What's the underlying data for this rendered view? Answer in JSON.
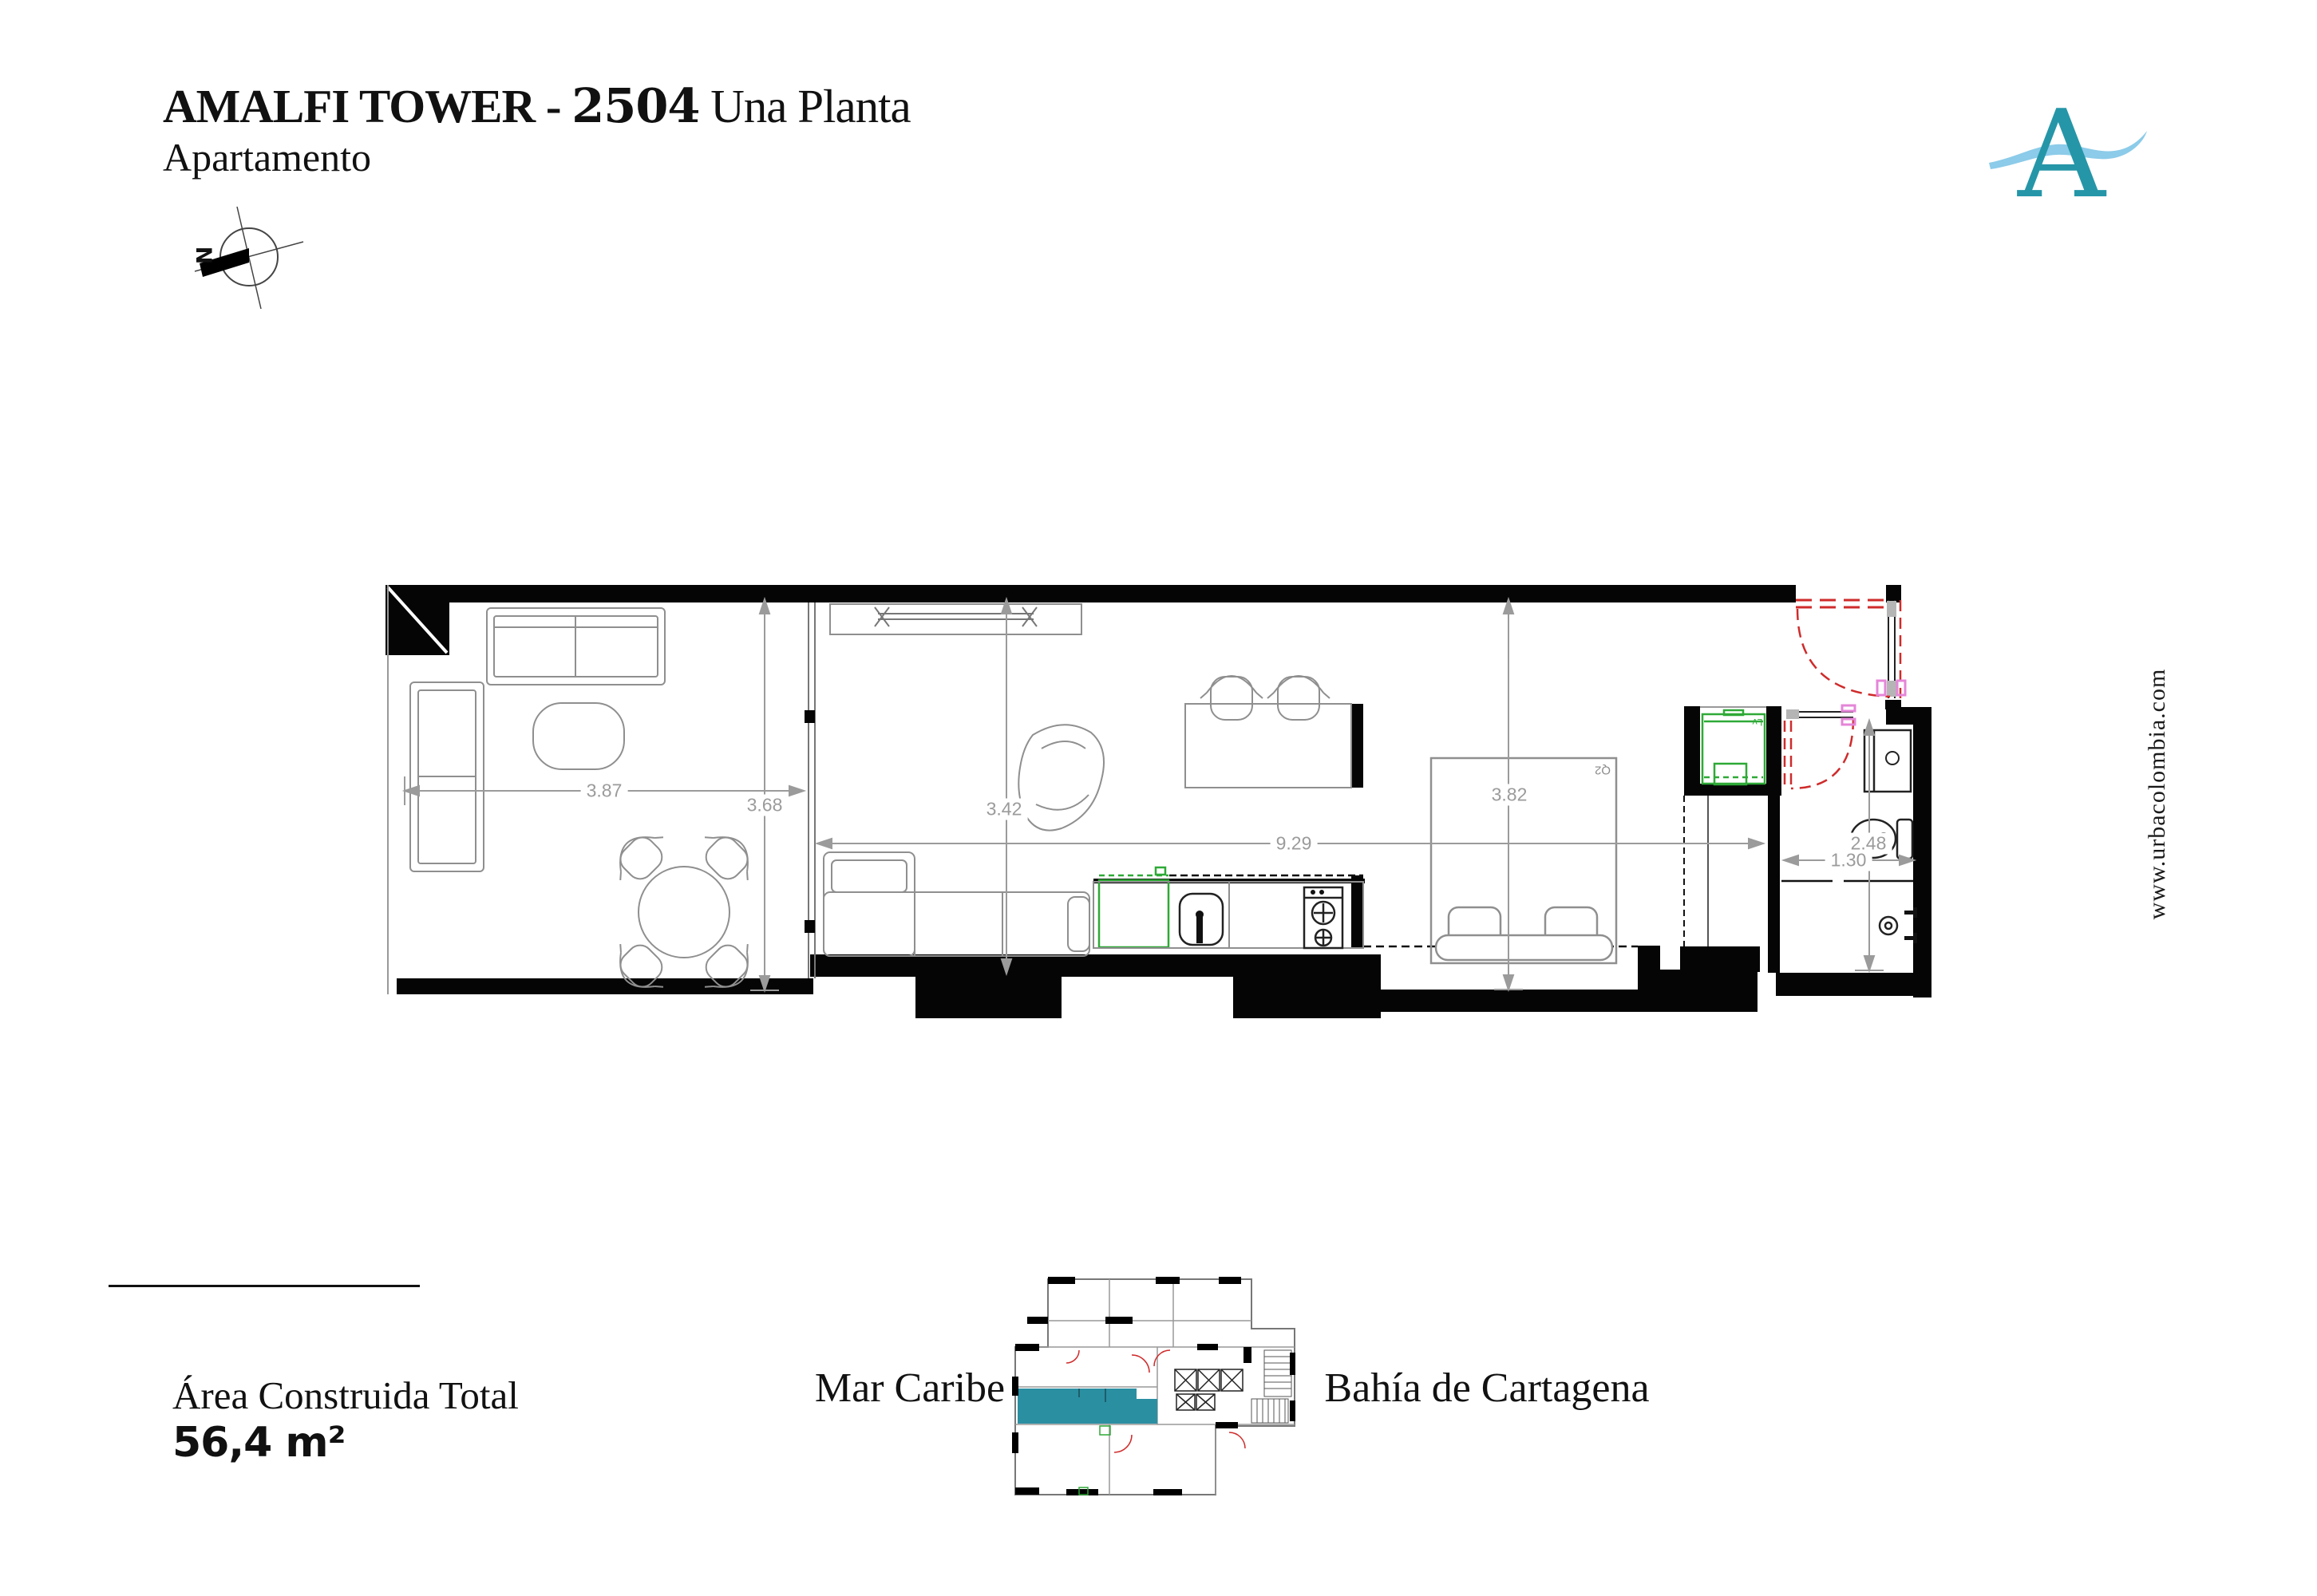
{
  "header": {
    "title_main": "AMALFI TOWER - ",
    "title_number": "2504",
    "title_suffix": " Una Planta",
    "subtitle": "Apartamento"
  },
  "compass": {
    "north_label": "N"
  },
  "logo": {
    "letter": "A"
  },
  "plan": {
    "dimensions": {
      "balcony_width": "3.87",
      "balcony_depth": "3.68",
      "living_depth": "3.42",
      "total_length": "9.29",
      "bedroom_width": "3.82",
      "bathroom_depth": "2.48",
      "bathroom_width": "1.30"
    },
    "labels": {
      "bed": "Q2",
      "washer": "Lv"
    }
  },
  "footer": {
    "area_label": "Área Construida Total",
    "area_value": "56,4 m²",
    "sea_label_left": "Mar Caribe",
    "sea_label_right": "Bahía de Cartagena"
  },
  "sidebar": {
    "website": "www.urbacolombia.com"
  },
  "colors": {
    "logo_teal": "#2596a8",
    "wave_blue": "#8ccbe9",
    "unit_highlight_teal": "#2b8fa2",
    "door_red": "#cf2b2b",
    "frame_pink": "#e585d8",
    "appliance_green": "#2ea937",
    "dimension_gray": "#9b9b9b",
    "wall_black": "#050505"
  }
}
